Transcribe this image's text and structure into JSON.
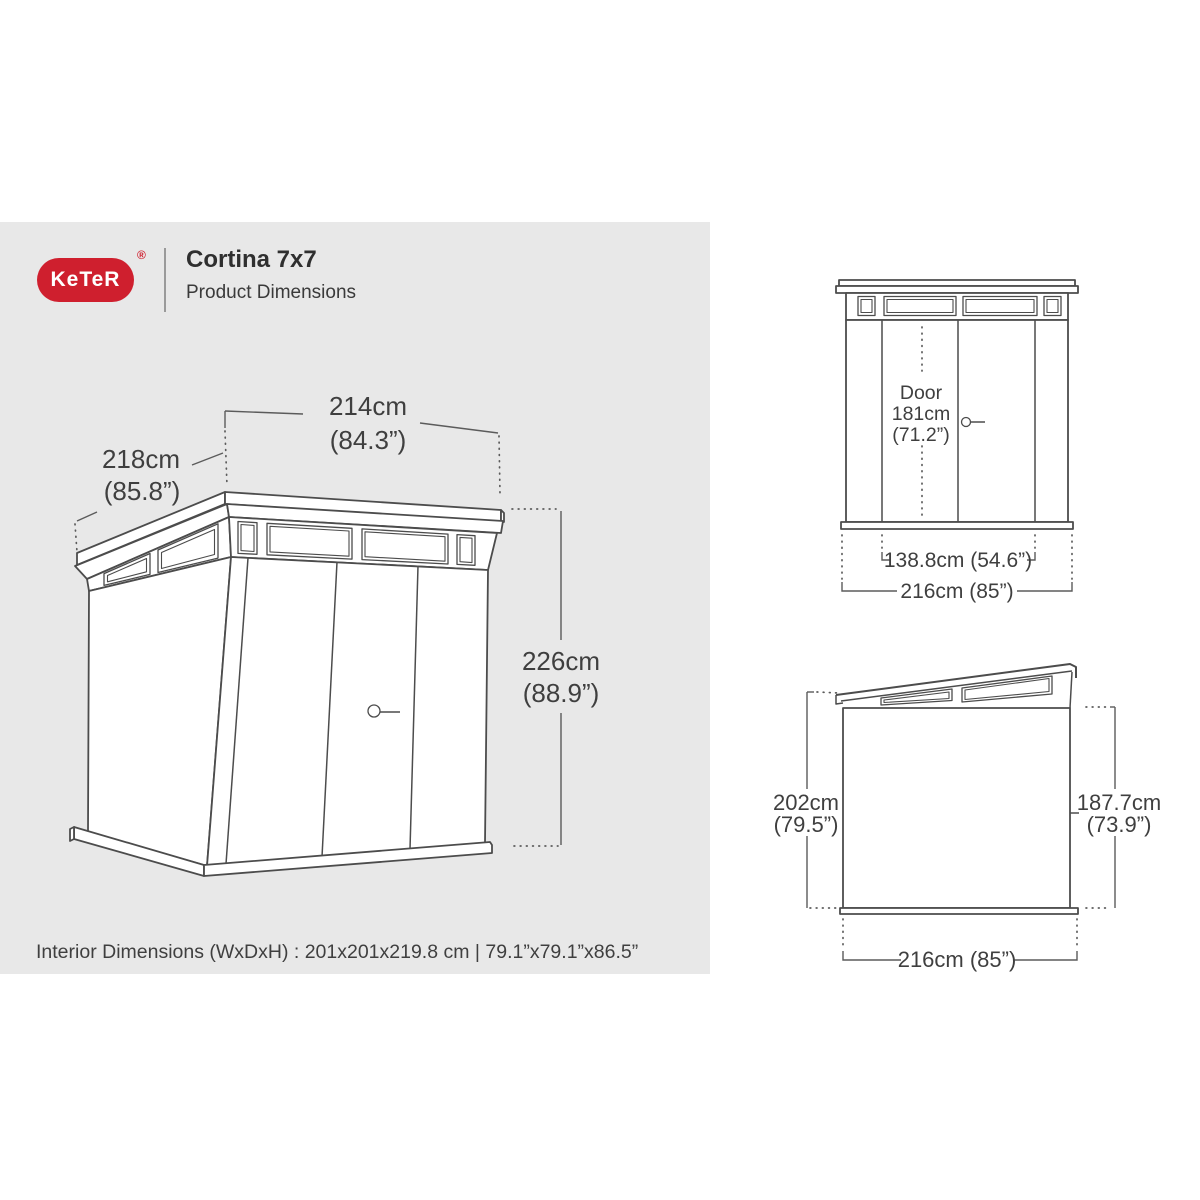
{
  "header": {
    "logo_text": "KeTeR",
    "registered_mark": "®",
    "title": "Cortina 7x7",
    "subtitle": "Product Dimensions"
  },
  "colors": {
    "brand_red": "#cf1f2e",
    "panel_gray": "#e8e8e8",
    "line_gray": "#4c4c4c",
    "text_gray": "#3f3f3f"
  },
  "isometric_view": {
    "width_cm": "214cm",
    "width_in": "(84.3”)",
    "depth_cm": "218cm",
    "depth_in": "(85.8”)",
    "height_cm": "226cm",
    "height_in": "(88.9”)"
  },
  "front_view": {
    "door_label": "Door",
    "door_height_cm": "181cm",
    "door_height_in": "(71.2”)",
    "door_width": "138.8cm (54.6”)",
    "overall_width": "216cm (85”)"
  },
  "side_view": {
    "rear_height_cm": "202cm",
    "rear_height_in": "(79.5”)",
    "wall_height_cm": "187.7cm",
    "wall_height_in": "(73.9”)",
    "depth": "216cm (85”)"
  },
  "footer": {
    "interior_dimensions": "Interior Dimensions (WxDxH) : 201x201x219.8 cm | 79.1”x79.1”x86.5”"
  }
}
